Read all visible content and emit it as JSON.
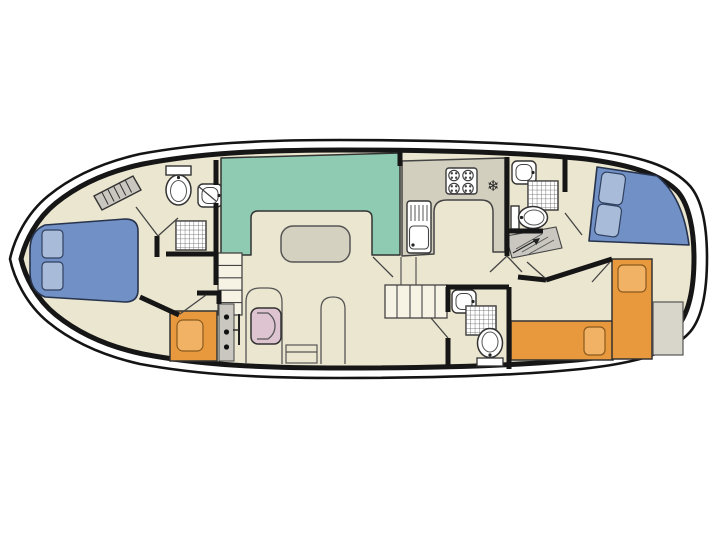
{
  "diagram": {
    "kind": "boat-floor-plan"
  },
  "icons": {
    "freezer": "❄"
  },
  "colors": {
    "background": "#ffffff",
    "hull_line": "#141414",
    "wall": "#161616",
    "floor": "#ebe6cf",
    "dinette_bench": "#8fcbb3",
    "table": "#d5d1c0",
    "counter": "#d2cfbf",
    "white_fixture": "#ffffff",
    "bed_blue": "#7191c6",
    "pillow_blue": "#a8bcda",
    "bed_orange": "#e9993d",
    "pillow_orange": "#f1b266",
    "chair_pink": "#dec4d1",
    "gray_fixture": "#c9c7bf",
    "gray_block": "#d8d5ca",
    "stairs_fill": "#f6f3e4"
  }
}
